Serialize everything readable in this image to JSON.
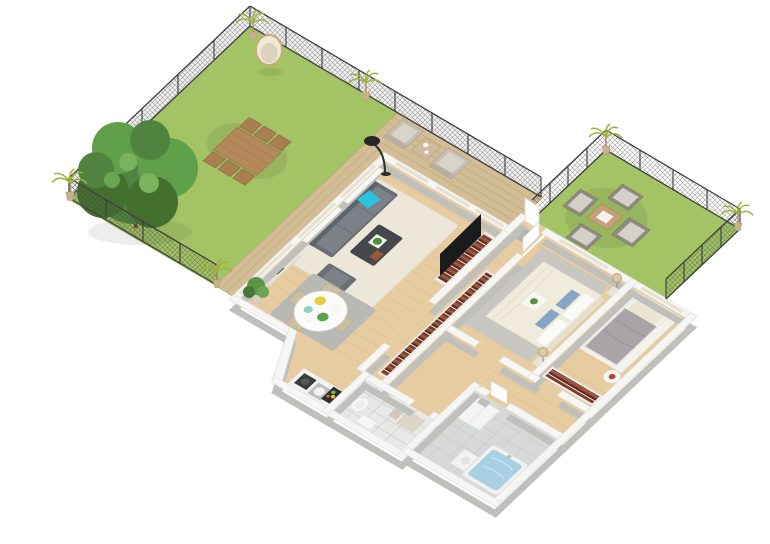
{
  "scene": {
    "description": "3D isometric rendering of an apartment floor plan with a large fenced garden, wooden terrace, second fenced patio garden, open living-dining-kitchen, hallway with bookshelves, master bedroom, second bedroom, bathroom with bathtub and a WC",
    "type": "architectural-3d-floor-plan-render",
    "background": "#ffffff"
  },
  "palette": {
    "lawn": "#a3c364",
    "deck": "#d3bd95",
    "floor": "#e7cc9f",
    "tile": "#d6d9d8",
    "tileLight": "#e8e9e7",
    "wallTop": "#f6f6f4",
    "wallSide": "#bfbfbc",
    "glass": "#e7e3d4",
    "fence": "#3f3f3f",
    "rugCream": "#ece7d9",
    "rugGray": "#b8b8b4",
    "rugBed": "#c8c6c1",
    "sofa": "#6a6f75",
    "sofaSeat": "#7b8187",
    "cyanPillow": "#29c2df",
    "coffeeTable": "#44474b",
    "gardenWood": "#b5895c",
    "gardenChair": "#a87e52",
    "terraceChair": "#c6bfb1",
    "terraceCushion": "#d9d4c9",
    "patioChair": "#918a83",
    "patioCushion": "#d5d1c8",
    "books1": "#7c3a2c",
    "books2": "#9a5638",
    "books3": "#612a1e",
    "bedCream": "#f0ebdc",
    "duvetGray": "#a9a4a7",
    "blueCushion": "#85a6c2",
    "water": "#a9cfe4",
    "treeDark": "#44702f",
    "tree": "#4f833f",
    "treeLight": "#61a04b",
    "palm": "#9fb23c",
    "white": "#f4f4f2"
  },
  "rooms": [
    {
      "name": "left-garden",
      "label": "Large fenced garden",
      "items": [
        "lawn",
        "large tree",
        "wooden dining table",
        "6 wooden chairs",
        "hanging egg chair",
        "potted palms",
        "chain-link fence"
      ]
    },
    {
      "name": "terrace",
      "label": "Wooden terrace",
      "items": [
        "deck boards",
        "2 lounge armchairs",
        "side table",
        "railing fence"
      ]
    },
    {
      "name": "right-garden",
      "label": "Patio garden",
      "items": [
        "lawn",
        "4 outdoor armchairs",
        "coffee table",
        "2 potted palms",
        "chain-link fence"
      ]
    },
    {
      "name": "living-room",
      "label": "Living room",
      "items": [
        "gray sofa",
        "cyan accent pillow",
        "gray armchair",
        "dark coffee table with plant",
        "cream rug",
        "black floor lamp",
        "TV on bookshelf unit",
        "sideboard",
        "white curtains"
      ]
    },
    {
      "name": "dining-area",
      "label": "Dining area",
      "items": [
        "round white table",
        "4 beige chairs",
        "gray rug",
        "plates with food",
        "potted plant"
      ]
    },
    {
      "name": "kitchen",
      "label": "Kitchen",
      "items": [
        "white counter",
        "cooktop with pan",
        "round sink",
        "stove with food"
      ]
    },
    {
      "name": "hallway",
      "label": "Entry hallway",
      "items": [
        "entry door",
        "gray doormat",
        "long bookshelf with red books",
        "white interior doors"
      ]
    },
    {
      "name": "master-bedroom",
      "label": "Master bedroom",
      "items": [
        "cream double bed",
        "blue cushions",
        "breakfast tray with plant",
        "2 nightstands",
        "2 bedside lamps",
        "gray rug"
      ]
    },
    {
      "name": "second-bedroom",
      "label": "Second bedroom",
      "items": [
        "single bed with gray duvet",
        "cream pillow",
        "white rug",
        "round side table with red flowers",
        "low bookshelf"
      ]
    },
    {
      "name": "bathroom",
      "label": "Bathroom",
      "items": [
        "gray tiled floor",
        "bathtub filled with water",
        "vanity cabinet",
        "washbasin"
      ]
    },
    {
      "name": "wc",
      "label": "WC / utility room",
      "items": [
        "toilet",
        "towels",
        "dressing table",
        "stool",
        "pale tiled floor"
      ]
    }
  ]
}
